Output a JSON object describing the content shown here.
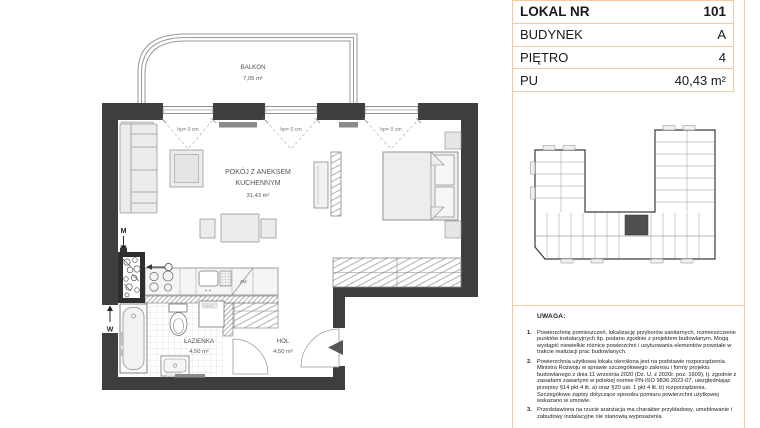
{
  "colors": {
    "accent_border": "#f3c9a2",
    "wall": "#3e3e3e",
    "unit_highlight": "#4f4f4f"
  },
  "unit_card": {
    "rows": [
      {
        "label": "LOKAL NR",
        "value": "101"
      },
      {
        "label": "BUDYNEK",
        "value": "A"
      },
      {
        "label": "PIĘTRO",
        "value": "4"
      },
      {
        "label": "PU",
        "value": "40,43 m²"
      }
    ]
  },
  "floor_plan": {
    "balcony_name": "BALKON",
    "balcony_area": "7,05 m²",
    "living_name_line1": "POKÓJ Z ANEKSEM",
    "living_name_line2": "KUCHENNYM",
    "living_area": "31,43 m²",
    "bathroom_name": "ŁAZIENKA",
    "bathroom_area": "4,50 m²",
    "hall_name": "HOL",
    "hall_area": "4,50 m²",
    "window_sill_label": "hp= 0 cm",
    "dishwasher_label": "ZM",
    "riser_labels": {
      "m": "M",
      "w": "W"
    }
  },
  "disclaimer": {
    "heading": "UWAGA:",
    "nums": [
      "1.",
      "2.",
      "3."
    ],
    "items": [
      "Powierzchnię pomieszczeń, lokalizację przyborów sanitarnych, rozmieszczenie punktów instalacyjnych itp. podano zgodnie z projektem budowlanym. Mogą wystąpić niewielkie różnice powierzchni i usytuowania elementów powstałe w trakcie realizacji prac budowlanych.",
      "Powierzchnia użytkowa lokalu określona jest na podstawie rozporządzenia Ministra Rozwoju w sprawie szczegółowego zakresu i formy projektu budowlanego z dnia 11 września 2020 (Dz. U. z 2020r. poz. 1609), tj. zgodnie z zasadami zawartymi w polskiej normie PN-ISO 9836:2022-07, uwzględniając przepisy §14 pkt 4 lit. a) oraz §20 ust. 1 pkt 4 lit. b) rozporządzenia. Szczegółowe zapisy dotyczące sposobu pomiaru powierzchni użytkowej wskazano w umowie.",
      "Przedstawiona na rzucie aranżacja ma charakter przykładowy, umeblowanie i zabudowy instalacyjne nie stanowią wyposażenia"
    ]
  }
}
